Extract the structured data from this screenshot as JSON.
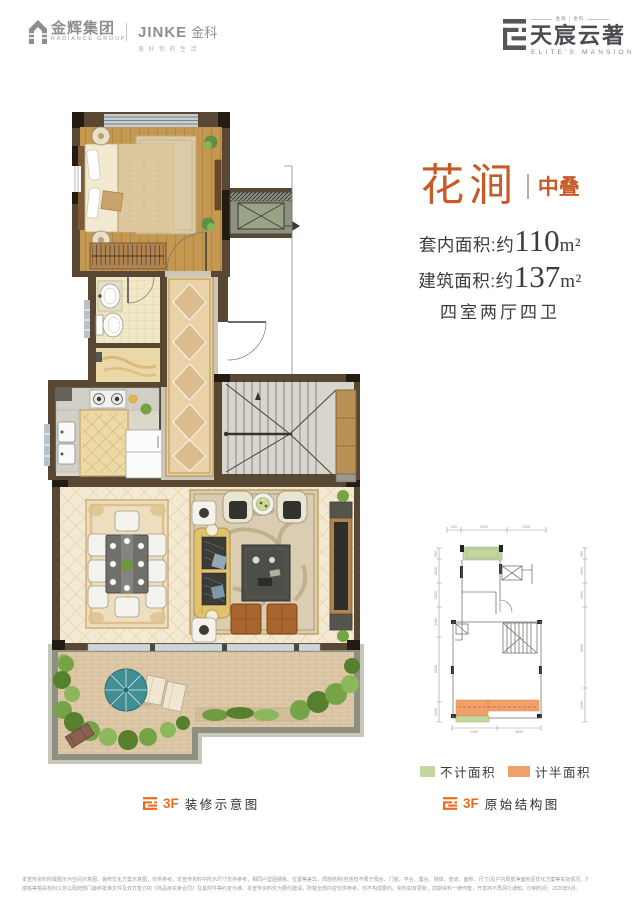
{
  "header": {
    "radiance": {
      "cn": "金辉集团",
      "en": "RADIANCE GROUP"
    },
    "jinke": {
      "en": "JINKE",
      "cn": "金科",
      "tagline": "美好你的生活"
    },
    "brand": {
      "top_small": "金辉 | 金科",
      "cn": "天宸云著",
      "en": "ELITE'S MANSION"
    }
  },
  "unit": {
    "name": "花涧",
    "tag": "中叠",
    "inner_label": "套内面积:约",
    "inner_value": "110",
    "inner_unit": "m²",
    "build_label": "建筑面积:约",
    "build_value": "137",
    "build_unit": "m²",
    "rooms": "四室两厅四卫"
  },
  "captions": {
    "left_floor": "3F",
    "left_label": "装修示意图",
    "right_floor": "3F",
    "right_label": "原始结构图"
  },
  "legend": {
    "items": [
      {
        "label": "不计面积",
        "color": "#c3d69b"
      },
      {
        "label": "计半面积",
        "color": "#f2a06a"
      }
    ]
  },
  "colors": {
    "title_orange": "#c75b28",
    "caption_orange": "#f06a1e",
    "wall_brown": "#584732"
  },
  "mini_plan": {
    "dims_top": [
      "650",
      "3400",
      "2050"
    ],
    "dims_left": [
      "900",
      "2600",
      "2500",
      "3300",
      "6500",
      "2000"
    ],
    "dims_right": [
      "900",
      "2600",
      "2500",
      "6000",
      "2000"
    ],
    "dims_bottom": [
      "2550",
      "3600"
    ]
  },
  "disclaimer": {
    "line1": "本宣传资料所载图示为空间示意图，装修优化方案示意图，仅供参考。本宣传资料中所示尺寸仅供参考，相同户型因楼栋、位置等差异，局部结构(包括但不限于阳台、门窗、平台、露台、墙体、管道、面积、尺寸)及户内局部净面积因优化方案等实际情况，均可能不同，仅供参考，商品房实际交付时，",
    "line2": "楼栋等相关权利义务以政府部门最终批准文件及双方签订的《商品房买卖合同》及其附件等约定为准。本宣传资料仅为要约邀请，所载全部内容仅供参考，均不构成要约。资料如有更新，前期资料一律作废，开发商不再另行通知。印制时间：2020年6月。"
  }
}
